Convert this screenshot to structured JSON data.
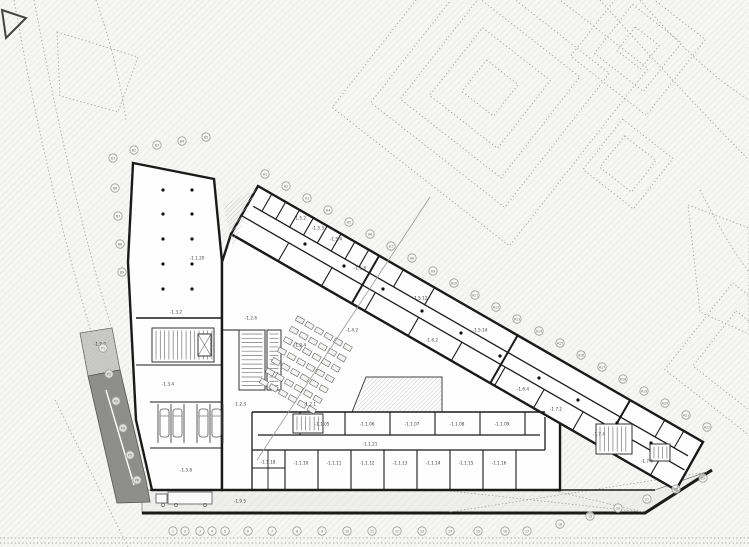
{
  "meta": {
    "drawing_title": "Underground floor plan — level -1"
  },
  "canvas": {
    "w": 749,
    "h": 547
  },
  "colors": {
    "paper": "#f6f6f4",
    "hatch_line": "#dddddc",
    "hatch_dense": "#bdbdbb",
    "wall": "#1a1a1a",
    "room_fill": "#fefefe",
    "band_fill": "#eeeeec",
    "ramp_light": "#c9c9c5",
    "ramp_dark": "#8e8e8a",
    "dotted_outline": "#a3a3a1",
    "furniture": "#555555",
    "tread": "#777777",
    "label_text": "#3c3c3a",
    "bubble_stroke": "#9b9b99",
    "bubble_text": "#6a6a68",
    "section_line": "#999997",
    "column_dot": "#111111"
  },
  "neighbors": {
    "nested_squares": [
      {
        "cx": 490,
        "cy": 88,
        "rot": 38,
        "sizes": [
          225,
          170,
          128,
          86,
          40
        ]
      },
      {
        "cx": 638,
        "cy": 48,
        "rot": 38,
        "sizes": [
          96,
          62,
          30
        ]
      },
      {
        "cx": 628,
        "cy": 164,
        "rot": 38,
        "sizes": [
          64,
          40
        ]
      },
      {
        "cx": 742,
        "cy": 360,
        "rot": 38,
        "sizes": [
          110,
          70
        ]
      }
    ],
    "quads": [
      [
        [
          57,
          32
        ],
        [
          138,
          57
        ],
        [
          118,
          112
        ],
        [
          60,
          96
        ]
      ],
      [
        [
          688,
          205
        ],
        [
          749,
          228
        ],
        [
          749,
          334
        ],
        [
          700,
          312
        ]
      ]
    ],
    "curves": [
      "M14,0C30,90 52,200 92,335",
      "M34,0C52,95 76,210 112,330",
      "M640,0Q700,70 749,100",
      "M600,0Q680,90 749,160",
      "M700,190Q728,245 749,272",
      "M96,0C110,40 120,80 126,120",
      "M55,400L128,547"
    ],
    "bottom_lines": [
      538,
      543
    ],
    "dark_triangle": [
      [
        2,
        10
      ],
      [
        26,
        18
      ],
      [
        6,
        38
      ]
    ]
  },
  "building": {
    "volumes": [
      {
        "name": "west-block",
        "points": [
          [
            133,
            163
          ],
          [
            214,
            179
          ],
          [
            222,
            262
          ],
          [
            222,
            490
          ],
          [
            152,
            490
          ],
          [
            136,
            420
          ],
          [
            128,
            262
          ]
        ]
      },
      {
        "name": "central-block",
        "points": [
          [
            222,
            262
          ],
          [
            231,
            234
          ],
          [
            560,
            423
          ],
          [
            560,
            490
          ],
          [
            222,
            490
          ]
        ]
      },
      {
        "name": "wing",
        "points": [
          [
            258,
            186
          ],
          [
            703,
            442
          ],
          [
            676,
            490
          ],
          [
            231,
            234
          ]
        ]
      }
    ],
    "band": {
      "points": [
        [
          142,
          490
        ],
        [
          655,
          490
        ],
        [
          712,
          470
        ],
        [
          645,
          513
        ],
        [
          142,
          513
        ]
      ],
      "south_wall": "M142,513L645,513L712,470"
    },
    "ramp": {
      "light": [
        [
          80,
          333
        ],
        [
          112,
          328
        ],
        [
          120,
          370
        ],
        [
          88,
          376
        ]
      ],
      "dark": [
        [
          88,
          376
        ],
        [
          120,
          370
        ],
        [
          146,
          480
        ],
        [
          150,
          502
        ],
        [
          117,
          503
        ]
      ],
      "lane": [
        106,
        390,
        134,
        485
      ]
    },
    "void_hatches": [
      {
        "points": [
          [
            223,
            205
          ],
          [
            256,
            189
          ],
          [
            233,
            248
          ]
        ],
        "stroke": false
      },
      {
        "points": [
          [
            366,
            377
          ],
          [
            442,
            377
          ],
          [
            442,
            412
          ],
          [
            352,
            412
          ]
        ],
        "stroke": true
      }
    ],
    "walls": [
      [
        136,
        318,
        222,
        318,
        1.6
      ],
      [
        136,
        365,
        222,
        365,
        1.1
      ],
      [
        150,
        402,
        222,
        402,
        1.1
      ],
      [
        150,
        448,
        222,
        448,
        1.1
      ],
      [
        252,
        412,
        545,
        412,
        1.6
      ],
      [
        258,
        435,
        540,
        435,
        1.3
      ],
      [
        252,
        450,
        545,
        450,
        1.3
      ],
      [
        150,
        490,
        655,
        490,
        1.6
      ],
      [
        300,
        412,
        300,
        435,
        1.1
      ],
      [
        345,
        412,
        345,
        435,
        1.1
      ],
      [
        390,
        412,
        390,
        435,
        1.1
      ],
      [
        435,
        412,
        435,
        435,
        1.1
      ],
      [
        480,
        412,
        480,
        435,
        1.1
      ],
      [
        525,
        412,
        525,
        435,
        1.1
      ],
      [
        285,
        450,
        285,
        490,
        1.1
      ],
      [
        318,
        450,
        318,
        490,
        1.1
      ],
      [
        351,
        450,
        351,
        490,
        1.1
      ],
      [
        384,
        450,
        384,
        490,
        1.1
      ],
      [
        417,
        450,
        417,
        490,
        1.1
      ],
      [
        450,
        450,
        450,
        490,
        1.1
      ],
      [
        483,
        450,
        483,
        490,
        1.1
      ],
      [
        516,
        450,
        516,
        490,
        1.1
      ],
      [
        252,
        412,
        252,
        490,
        1.3
      ],
      [
        268,
        450,
        268,
        490,
        0.9
      ],
      [
        252,
        468,
        285,
        468,
        0.9
      ],
      [
        545,
        417,
        545,
        450,
        1.3
      ],
      [
        222,
        330,
        239,
        330,
        1.1
      ]
    ],
    "wing_axis": {
      "origin": [
        258,
        186
      ],
      "dir": [
        0.866,
        0.497
      ],
      "normal": [
        -0.497,
        0.866
      ],
      "corridor": [
        {
          "o": 20,
          "s1": 6,
          "s2": 508
        },
        {
          "o": 34,
          "s1": 0,
          "s2": 512
        }
      ],
      "cross_walls": [
        {
          "o1": 0,
          "o2": 20,
          "w": 1.1,
          "s": [
            16,
            32,
            48,
            64,
            80,
            96,
            112,
            128,
            168,
            204,
            470,
            492
          ]
        },
        {
          "o1": 34,
          "o2": 55,
          "w": 1.1,
          "s": [
            55,
            105,
            155,
            205,
            255,
            305,
            350,
            395,
            440,
            485
          ]
        },
        {
          "o1": 0,
          "o2": 55,
          "w": 2.0,
          "s": [
            140,
            300,
            430
          ]
        }
      ]
    }
  },
  "stairs": [
    {
      "x": 152,
      "y": 328,
      "w": 62,
      "h": 34,
      "dir": "v"
    },
    {
      "x": 239,
      "y": 330,
      "w": 26,
      "h": 60,
      "dir": "h"
    },
    {
      "x": 267,
      "y": 330,
      "w": 14,
      "h": 60,
      "dir": "h"
    },
    {
      "x": 293,
      "y": 414,
      "w": 30,
      "h": 19,
      "dir": "v"
    },
    {
      "x": 596,
      "y": 424,
      "w": 36,
      "h": 30,
      "dir": "v"
    },
    {
      "x": 650,
      "y": 444,
      "w": 20,
      "h": 17,
      "dir": "v"
    }
  ],
  "elevators": [
    [
      198,
      334,
      13,
      22
    ]
  ],
  "shelves": {
    "start": [
      300,
      320
    ],
    "rows": 7,
    "cols": 6,
    "row_step": [
      -6,
      10.4
    ],
    "col_step": [
      9.53,
      5.47
    ],
    "box": [
      8,
      5
    ],
    "angle": 30
  },
  "parking": {
    "stall_x": [
      158,
      171,
      184,
      197,
      210,
      223
    ],
    "y1": 404,
    "y2": 443,
    "cars": [
      164.5,
      177.5,
      203.5,
      216.5
    ],
    "car_y": 423
  },
  "truck": {
    "trailer": [
      168,
      492,
      44,
      12
    ],
    "cab": [
      156,
      494,
      11,
      9
    ],
    "wheels": [
      [
        163,
        505
      ],
      [
        176,
        505
      ],
      [
        205,
        505
      ]
    ]
  },
  "columns": [
    [
      163,
      190
    ],
    [
      192,
      190
    ],
    [
      163,
      214
    ],
    [
      192,
      214
    ],
    [
      163,
      239
    ],
    [
      192,
      239
    ],
    [
      163,
      264
    ],
    [
      192,
      264
    ],
    [
      163,
      289
    ],
    [
      192,
      289
    ],
    [
      305,
      244
    ],
    [
      344,
      266
    ],
    [
      383,
      289
    ],
    [
      422,
      311
    ],
    [
      461,
      333
    ],
    [
      500,
      356
    ],
    [
      539,
      378
    ],
    [
      578,
      400
    ],
    [
      617,
      423
    ],
    [
      651,
      443
    ]
  ],
  "section_line": [
    430,
    197,
    257,
    460
  ],
  "band_dotted": [
    [
      450,
      491,
      643,
      512
    ],
    [
      450,
      512,
      707,
      472
    ],
    [
      555,
      491,
      643,
      512
    ]
  ],
  "labels": [
    {
      "t": "-1.1.20",
      "x": 197,
      "y": 258
    },
    {
      "t": "-1.3.2",
      "x": 176,
      "y": 312
    },
    {
      "t": "-1.3.4",
      "x": 168,
      "y": 384
    },
    {
      "t": "-1.3.8",
      "x": 186,
      "y": 470
    },
    {
      "t": "-1.2.6",
      "x": 251,
      "y": 318
    },
    {
      "t": "-1.2.4",
      "x": 300,
      "y": 345
    },
    {
      "t": "-1.2.1",
      "x": 310,
      "y": 404
    },
    {
      "t": "-1.2.3",
      "x": 240,
      "y": 404
    },
    {
      "t": "-1.4.2",
      "x": 352,
      "y": 330
    },
    {
      "t": "-1.5.2",
      "x": 300,
      "y": 218
    },
    {
      "t": "-1.5.3",
      "x": 318,
      "y": 228
    },
    {
      "t": "-1.5.4",
      "x": 336,
      "y": 239
    },
    {
      "t": "-1.5.8",
      "x": 360,
      "y": 268
    },
    {
      "t": "-1.5.12",
      "x": 420,
      "y": 298
    },
    {
      "t": "-1.5.14",
      "x": 480,
      "y": 330
    },
    {
      "t": "-1.6.2",
      "x": 432,
      "y": 340
    },
    {
      "t": "-1.6.4",
      "x": 523,
      "y": 389
    },
    {
      "t": "-1.7.2",
      "x": 556,
      "y": 409
    },
    {
      "t": "-1.7.4",
      "x": 599,
      "y": 434
    },
    {
      "t": "-1.7.6",
      "x": 647,
      "y": 461
    },
    {
      "t": "-1.1.21",
      "x": 370,
      "y": 444
    },
    {
      "t": "-1.1.05",
      "x": 322,
      "y": 424
    },
    {
      "t": "-1.1.06",
      "x": 367,
      "y": 424
    },
    {
      "t": "-1.1.07",
      "x": 412,
      "y": 424
    },
    {
      "t": "-1.1.08",
      "x": 457,
      "y": 424
    },
    {
      "t": "-1.1.09",
      "x": 502,
      "y": 424
    },
    {
      "t": "-1.1.10",
      "x": 301,
      "y": 463
    },
    {
      "t": "-1.1.11",
      "x": 334,
      "y": 463
    },
    {
      "t": "-1.1.12",
      "x": 367,
      "y": 463
    },
    {
      "t": "-1.1.13",
      "x": 400,
      "y": 463
    },
    {
      "t": "-1.1.14",
      "x": 433,
      "y": 463
    },
    {
      "t": "-1.1.15",
      "x": 466,
      "y": 463
    },
    {
      "t": "-1.1.16",
      "x": 499,
      "y": 463
    },
    {
      "t": "-1.1.18",
      "x": 268,
      "y": 462
    },
    {
      "t": "-1.9.5",
      "x": 240,
      "y": 501
    },
    {
      "t": "-1.9.2",
      "x": 100,
      "y": 344
    }
  ],
  "grid_bubbles": {
    "bottom": [
      {
        "l": "1",
        "x": 173,
        "y": 531
      },
      {
        "l": "2",
        "x": 185,
        "y": 531
      },
      {
        "l": "3",
        "x": 200,
        "y": 531
      },
      {
        "l": "4",
        "x": 212,
        "y": 531
      },
      {
        "l": "5",
        "x": 225,
        "y": 531
      },
      {
        "l": "6",
        "x": 248,
        "y": 531
      },
      {
        "l": "7",
        "x": 272,
        "y": 531
      },
      {
        "l": "8",
        "x": 297,
        "y": 531
      },
      {
        "l": "9",
        "x": 322,
        "y": 531
      },
      {
        "l": "10",
        "x": 347,
        "y": 531
      },
      {
        "l": "11",
        "x": 372,
        "y": 531
      },
      {
        "l": "12",
        "x": 397,
        "y": 531
      },
      {
        "l": "13",
        "x": 422,
        "y": 531
      },
      {
        "l": "14",
        "x": 450,
        "y": 531
      },
      {
        "l": "15",
        "x": 478,
        "y": 531
      },
      {
        "l": "16",
        "x": 505,
        "y": 531
      },
      {
        "l": "17",
        "x": 527,
        "y": 531
      },
      {
        "l": "18",
        "x": 560,
        "y": 524
      },
      {
        "l": "19",
        "x": 590,
        "y": 516
      },
      {
        "l": "20",
        "x": 618,
        "y": 508
      },
      {
        "l": "21",
        "x": 647,
        "y": 499
      },
      {
        "l": "22",
        "x": 676,
        "y": 489
      },
      {
        "l": "23",
        "x": 703,
        "y": 478
      }
    ],
    "diagonal": [
      {
        "l": "A1",
        "x": 265,
        "y": 174
      },
      {
        "l": "A2",
        "x": 286,
        "y": 186
      },
      {
        "l": "A3",
        "x": 307,
        "y": 198
      },
      {
        "l": "A4",
        "x": 328,
        "y": 210
      },
      {
        "l": "A5",
        "x": 349,
        "y": 222
      },
      {
        "l": "A6",
        "x": 370,
        "y": 234
      },
      {
        "l": "A7",
        "x": 391,
        "y": 246
      },
      {
        "l": "A8",
        "x": 412,
        "y": 258
      },
      {
        "l": "A9",
        "x": 433,
        "y": 271
      },
      {
        "l": "A10",
        "x": 454,
        "y": 283
      },
      {
        "l": "A11",
        "x": 475,
        "y": 295
      },
      {
        "l": "A12",
        "x": 496,
        "y": 307
      },
      {
        "l": "A13",
        "x": 517,
        "y": 319
      },
      {
        "l": "A14",
        "x": 539,
        "y": 331
      },
      {
        "l": "A15",
        "x": 560,
        "y": 343
      },
      {
        "l": "A16",
        "x": 581,
        "y": 355
      },
      {
        "l": "A17",
        "x": 602,
        "y": 367
      },
      {
        "l": "A18",
        "x": 623,
        "y": 379
      },
      {
        "l": "A19",
        "x": 644,
        "y": 391
      },
      {
        "l": "A20",
        "x": 665,
        "y": 403
      },
      {
        "l": "A21",
        "x": 686,
        "y": 415
      },
      {
        "l": "A22",
        "x": 707,
        "y": 427
      }
    ],
    "west": [
      {
        "l": "B1",
        "x": 113,
        "y": 158
      },
      {
        "l": "B2",
        "x": 134,
        "y": 150
      },
      {
        "l": "B3",
        "x": 157,
        "y": 145
      },
      {
        "l": "B4",
        "x": 182,
        "y": 141
      },
      {
        "l": "B5",
        "x": 206,
        "y": 137
      },
      {
        "l": "B6",
        "x": 115,
        "y": 188
      },
      {
        "l": "B7",
        "x": 118,
        "y": 216
      },
      {
        "l": "B8",
        "x": 120,
        "y": 244
      },
      {
        "l": "B9",
        "x": 122,
        "y": 272
      }
    ],
    "ramp_row": [
      {
        "l": "P1",
        "x": 103,
        "y": 348
      },
      {
        "l": "P2",
        "x": 109,
        "y": 374
      },
      {
        "l": "P3",
        "x": 116,
        "y": 401
      },
      {
        "l": "P4",
        "x": 123,
        "y": 428
      },
      {
        "l": "P5",
        "x": 130,
        "y": 455
      },
      {
        "l": "P6",
        "x": 137,
        "y": 480
      }
    ]
  }
}
